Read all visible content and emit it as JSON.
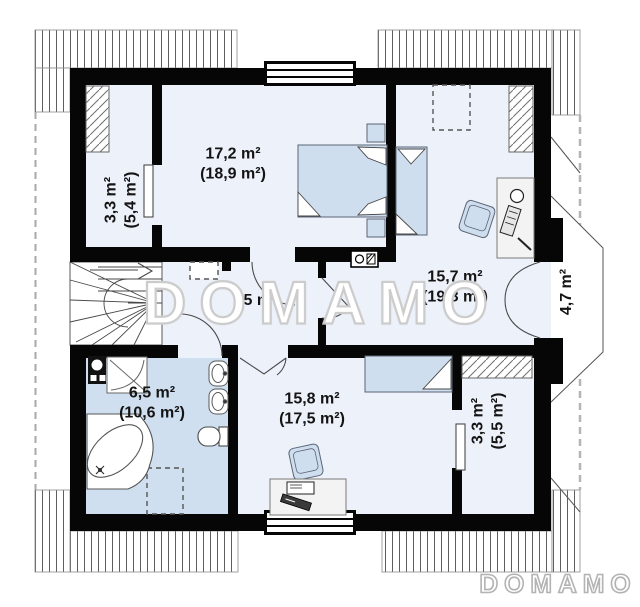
{
  "watermark": "DOMAMO",
  "logo": "DOMAMO",
  "rooms": {
    "wardrobe_top": {
      "area": "3,3 m²",
      "floor_area": "(5,4 m²)"
    },
    "bedroom_top": {
      "area": "17,2 m²",
      "floor_area": "(18,9 m²)"
    },
    "bedroom_right": {
      "area": "15,7 m²",
      "floor_area": "(19,8 m²)"
    },
    "balcony": {
      "area": "4,7 m²"
    },
    "hall": {
      "area": "5 m²"
    },
    "bathroom": {
      "area": "6,5 m²",
      "floor_area": "(10,6 m²)"
    },
    "bedroom_bottom": {
      "area": "15,8 m²",
      "floor_area": "(17,5 m²)"
    },
    "wardrobe_bottom": {
      "area": "3,3 m²",
      "floor_area": "(5,5 m²)"
    }
  },
  "colors": {
    "wall": "#060606",
    "room_floor": "#edf1fa",
    "bathroom_floor": "#cfdfef",
    "furniture_fill": "#cfdeef",
    "roof_hatch_line": "#5f5f5f",
    "watermark_outline": "#cccccc"
  }
}
